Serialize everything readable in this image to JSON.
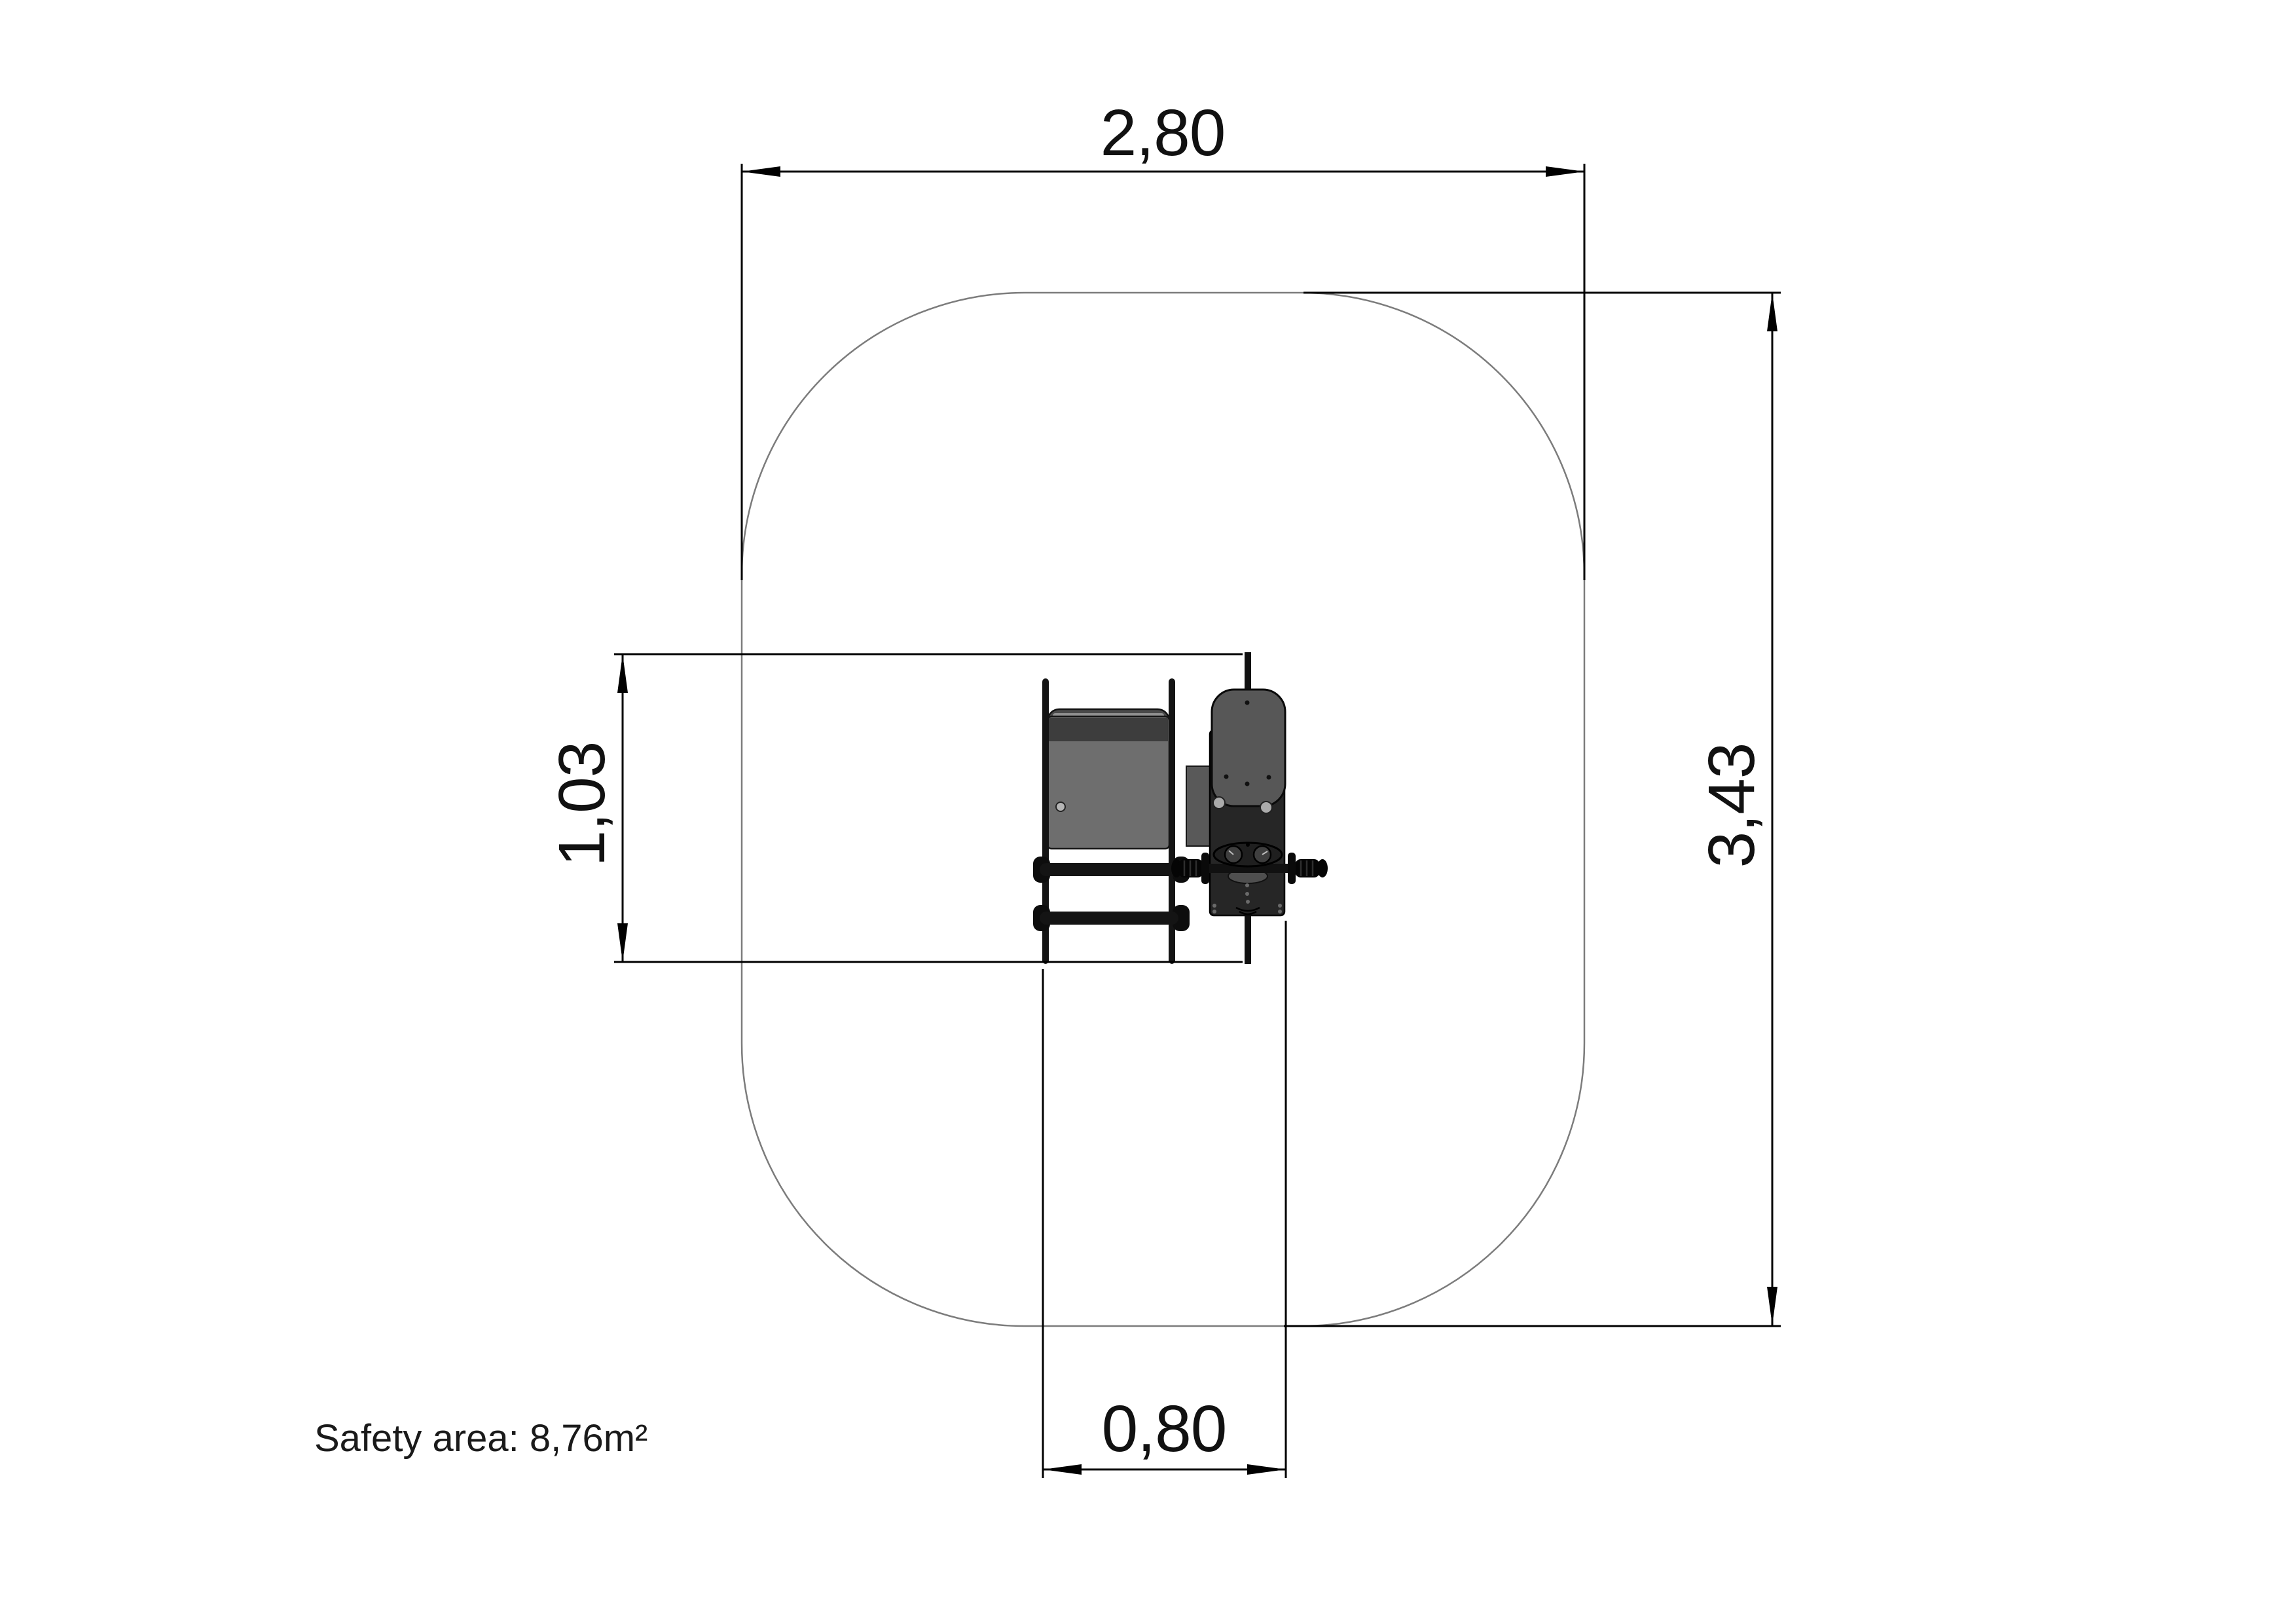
{
  "drawing": {
    "type_note": "playground equipment safety-area plan view",
    "safety_area": {
      "label": "Safety area: 8,76m²"
    },
    "dimensions": {
      "overall_width": "2,80",
      "overall_height": "3,43",
      "equipment_depth": "1,03",
      "equipment_width": "0,80"
    },
    "colors": {
      "safety_outline": "#7c7c7c",
      "dimension_lines": "#000000",
      "equipment_dark": "#141414",
      "equipment_gray": "#6e6e6e"
    }
  }
}
